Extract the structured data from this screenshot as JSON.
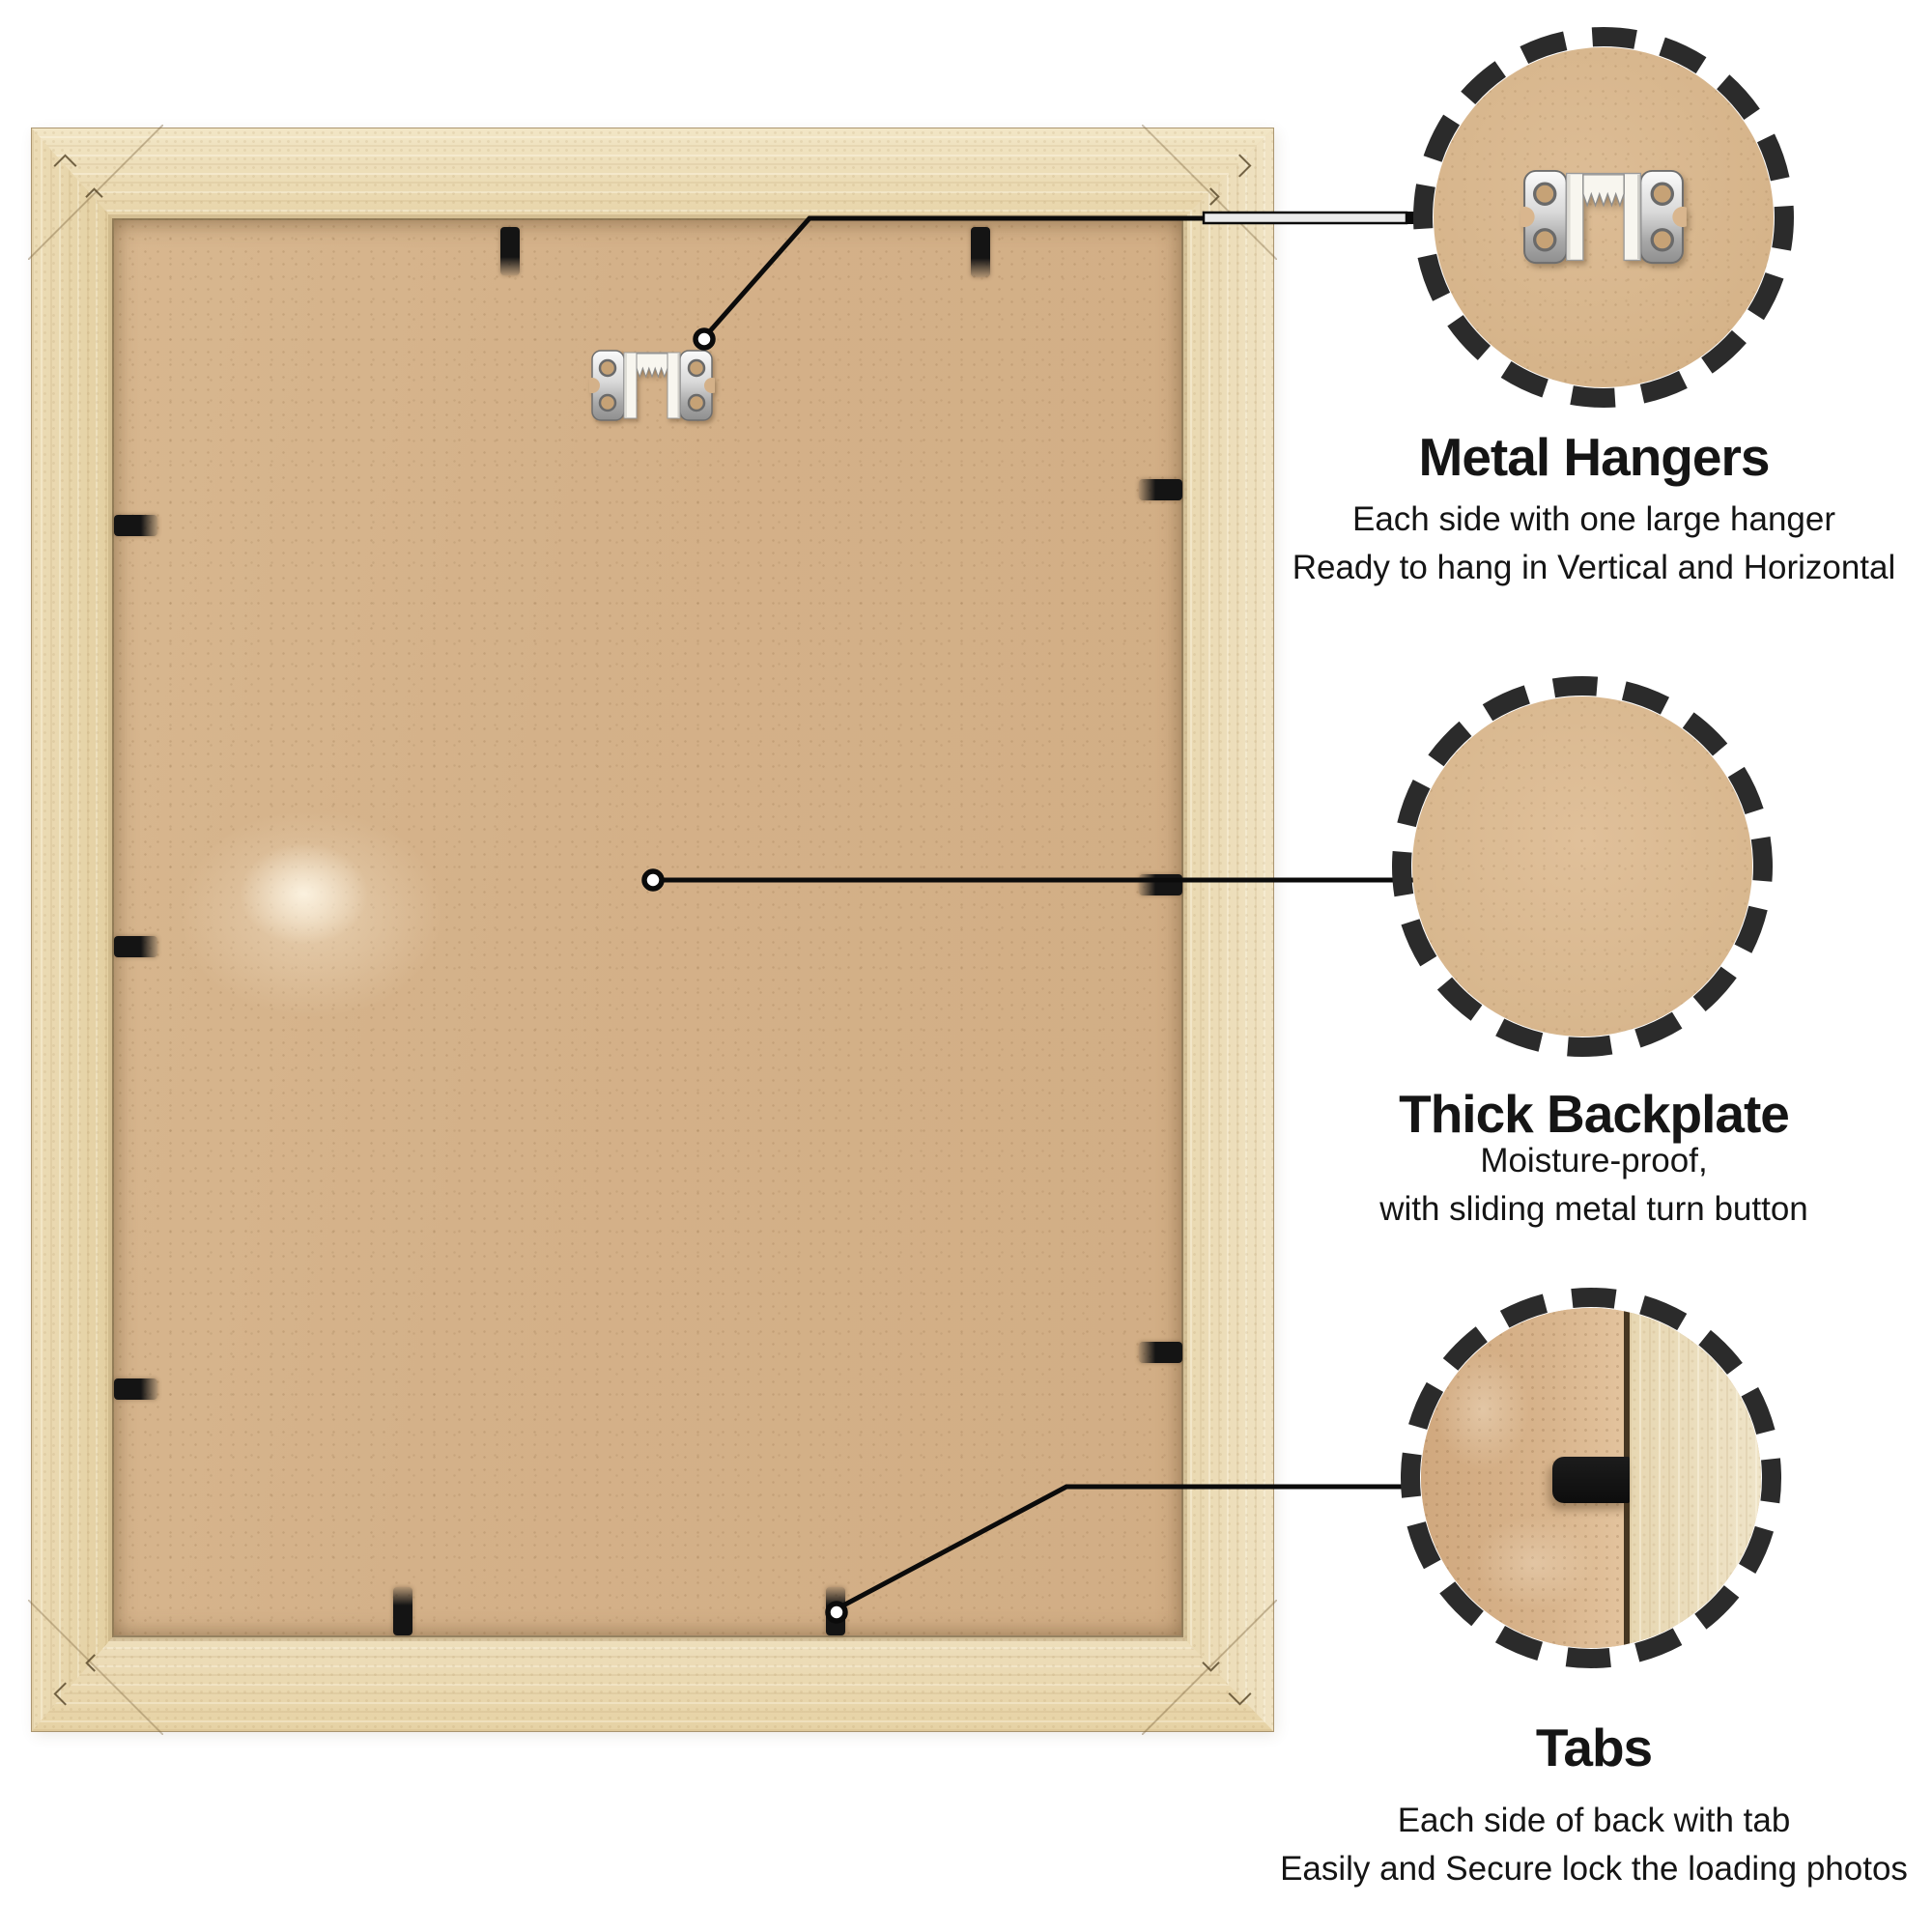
{
  "product": {
    "name": "Picture frame back view",
    "frame_wood_color": "#e9d7ac",
    "backplate_color": "#d5b189",
    "hardware": {
      "hanger_icon": "sawtooth-hanger-icon",
      "tab_icon": "locking-tab",
      "tab_color": "#1a1a1a",
      "visible_tabs": 10,
      "visible_hangers": 1
    }
  },
  "callouts": [
    {
      "id": "metal-hangers",
      "title": "Metal Hangers",
      "lines": [
        "Each side with one large hanger",
        "Ready to hang in Vertical and Horizontal"
      ],
      "detail_icon": "sawtooth-hanger-icon"
    },
    {
      "id": "thick-backplate",
      "title": "Thick Backplate",
      "lines": [
        "Moisture-proof,",
        "with sliding metal turn button"
      ],
      "detail_icon": "backplate-texture"
    },
    {
      "id": "tabs",
      "title": "Tabs",
      "lines": [
        "Each side of back with tab",
        "Easily and Secure lock the loading photos"
      ],
      "detail_icon": "tab-closeup"
    }
  ],
  "style": {
    "text_color": "#151515",
    "line_color": "#0b0b0b",
    "ring_color": "#2b2b2b",
    "background": "#ffffff"
  }
}
